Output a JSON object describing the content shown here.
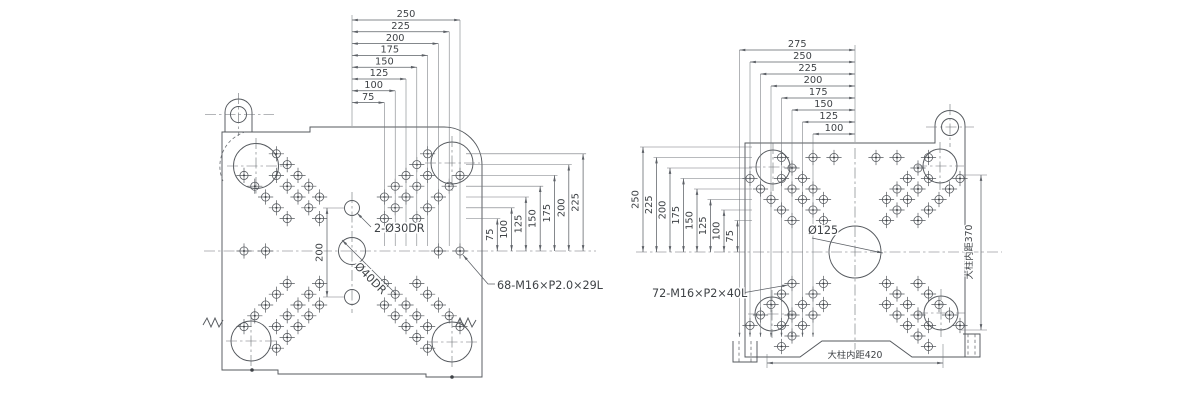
{
  "left_drawing": {
    "top_dims": [
      "250",
      "225",
      "200",
      "175",
      "150",
      "125",
      "100",
      "75"
    ],
    "right_dims": [
      "75",
      "100",
      "125",
      "150",
      "175",
      "200",
      "225"
    ],
    "center_height_dim": "200",
    "guide_pin_label": "2-Ø30DR",
    "center_hole_label": "Ø40DR",
    "bolt_pattern_label": "68-M16×P2.0×29L"
  },
  "right_drawing": {
    "top_dims": [
      "275",
      "250",
      "225",
      "200",
      "175",
      "150",
      "125",
      "100"
    ],
    "left_dims": [
      "250",
      "225",
      "200",
      "175",
      "150",
      "125",
      "100",
      "75"
    ],
    "center_hole_label": "Ø125",
    "bolt_pattern_label": "72-M16×P2×40L",
    "tie_bar_inner_vertical": "大柱内距370",
    "tie_bar_inner_horizontal": "大柱内距420"
  },
  "colors": {
    "line": "#5c6066",
    "text": "#3e4246",
    "background": "#ffffff"
  }
}
